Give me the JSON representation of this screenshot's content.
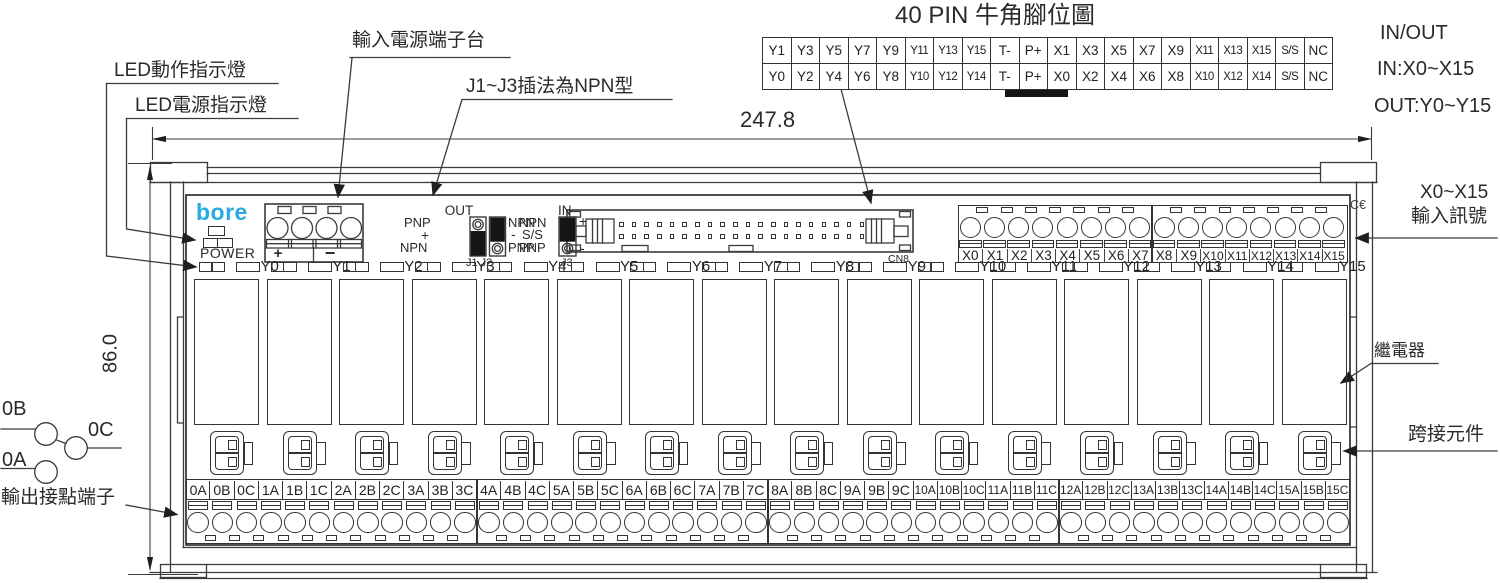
{
  "header": {
    "title": "40 PIN 牛角腳位圖",
    "io_note": [
      "IN/OUT",
      "IN:X0~X15",
      "OUT:Y0~Y15"
    ]
  },
  "pin_table": {
    "rows": [
      [
        "Y1",
        "Y3",
        "Y5",
        "Y7",
        "Y9",
        "Y11",
        "Y13",
        "Y15",
        "T-",
        "P+",
        "X1",
        "X3",
        "X5",
        "X7",
        "X9",
        "X11",
        "X13",
        "X15",
        "S/S",
        "NC"
      ],
      [
        "Y0",
        "Y2",
        "Y4",
        "Y6",
        "Y8",
        "Y10",
        "Y12",
        "Y14",
        "T-",
        "P+",
        "X0",
        "X2",
        "X4",
        "X6",
        "X8",
        "X10",
        "X12",
        "X14",
        "S/S",
        "NC"
      ]
    ]
  },
  "callouts": {
    "power_input": "輸入電源端子台",
    "led_action": "LED動作指示燈",
    "led_power": "LED電源指示燈",
    "jumper_note": "J1~J3插法為NPN型",
    "input_signal": [
      "X0~X15",
      "輸入訊號"
    ],
    "relay": "繼電器",
    "bridge": "跨接元件",
    "output_contact": "輸出接點端子"
  },
  "dimensions": {
    "width": "247.8",
    "height": "86.0"
  },
  "board": {
    "brand": "bore",
    "brand_color": "#29a9e1",
    "power_label": "POWER",
    "power_plus": "+",
    "power_minus": "−",
    "ce_mark": "C€",
    "connector_label": "CN8"
  },
  "jumpers": {
    "out": {
      "title": "OUT",
      "left": [
        "PNP",
        "+",
        "NPN"
      ],
      "right": [
        "NPN",
        "-",
        "PNP"
      ],
      "label": "J1 J2"
    },
    "in": {
      "title": "IN",
      "left": [
        "NPN",
        "S/S",
        "PNP"
      ],
      "right": [
        "+",
        "-"
      ],
      "label": "J3"
    }
  },
  "contact_diagram": {
    "b": "0B",
    "c": "0C",
    "a": "0A"
  },
  "x_labels": [
    "X0",
    "X1",
    "X2",
    "X3",
    "X4",
    "X5",
    "X6",
    "X7",
    "X8",
    "X9",
    "X10",
    "X11",
    "X12",
    "X13",
    "X14",
    "X15"
  ],
  "y_labels": [
    "Y0",
    "Y1",
    "Y2",
    "Y3",
    "Y4",
    "Y5",
    "Y6",
    "Y7",
    "Y8",
    "Y9",
    "Y10",
    "Y11",
    "Y12",
    "Y13",
    "Y14",
    "Y15"
  ],
  "output_labels": [
    "0A",
    "0B",
    "0C",
    "1A",
    "1B",
    "1C",
    "2A",
    "2B",
    "2C",
    "3A",
    "3B",
    "3C",
    "4A",
    "4B",
    "4C",
    "5A",
    "5B",
    "5C",
    "6A",
    "6B",
    "6C",
    "7A",
    "7B",
    "7C",
    "8A",
    "8B",
    "8C",
    "9A",
    "9B",
    "9C",
    "10A",
    "10B",
    "10C",
    "11A",
    "11B",
    "11C",
    "12A",
    "12B",
    "12C",
    "13A",
    "13B",
    "13C",
    "14A",
    "14B",
    "14C",
    "15A",
    "15B",
    "15C"
  ]
}
